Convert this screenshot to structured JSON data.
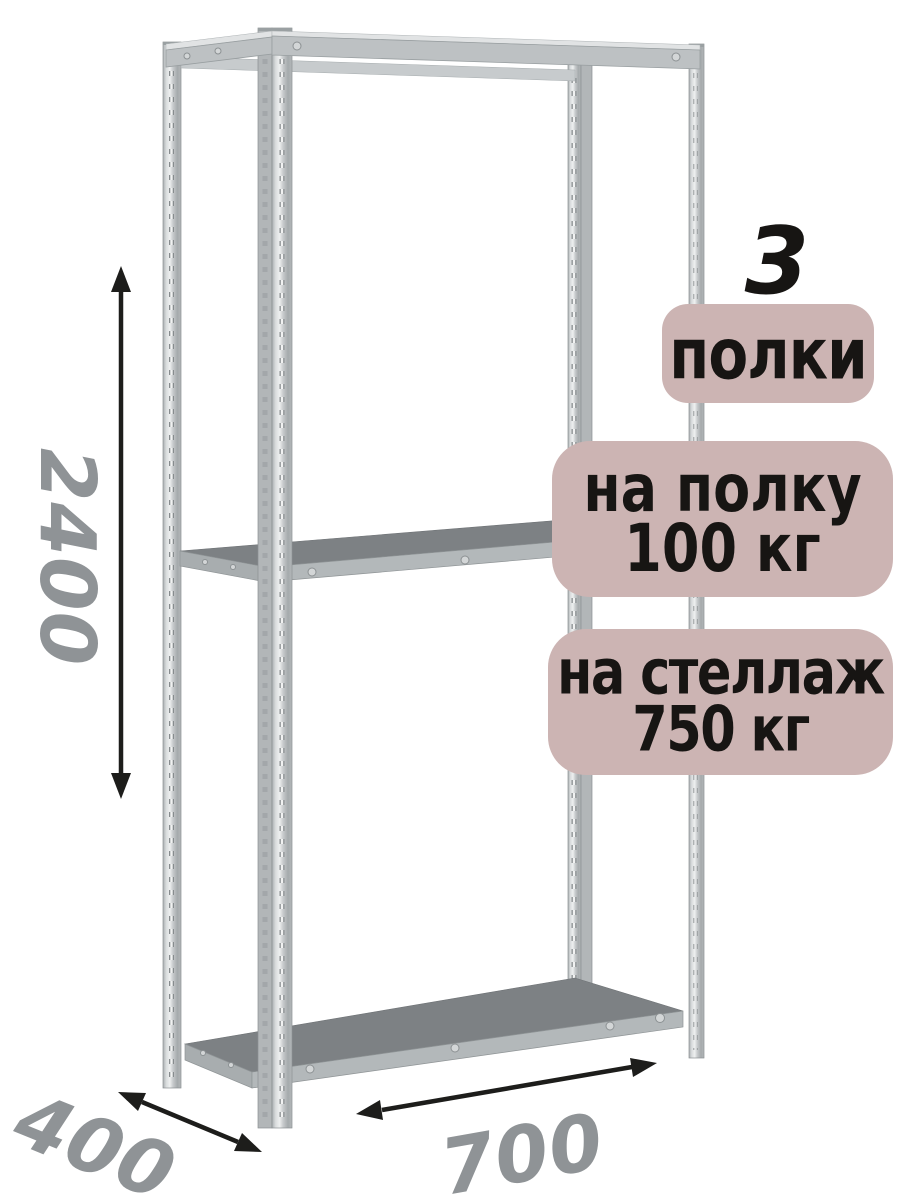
{
  "annotations": {
    "shelf_count": "3",
    "shelf_count_label": "полки",
    "per_shelf_label_line1": "на полку",
    "per_shelf_label_line2": "100 кг",
    "per_rack_label_line1": "на стеллаж",
    "per_rack_label_line2": "750 кг"
  },
  "dimensions": {
    "height_mm": "2400",
    "depth_mm": "400",
    "width_mm": "700"
  },
  "colors": {
    "badge-bg": "#ccb4b3",
    "label-text": "#171513",
    "dim-text": "#8f9396",
    "arrow": "#1d1d1b",
    "shelf-top": "#7d8184",
    "shelf-front": "#b3b8ba",
    "metal-dark": "#8c9193",
    "background": "#ffffff"
  }
}
